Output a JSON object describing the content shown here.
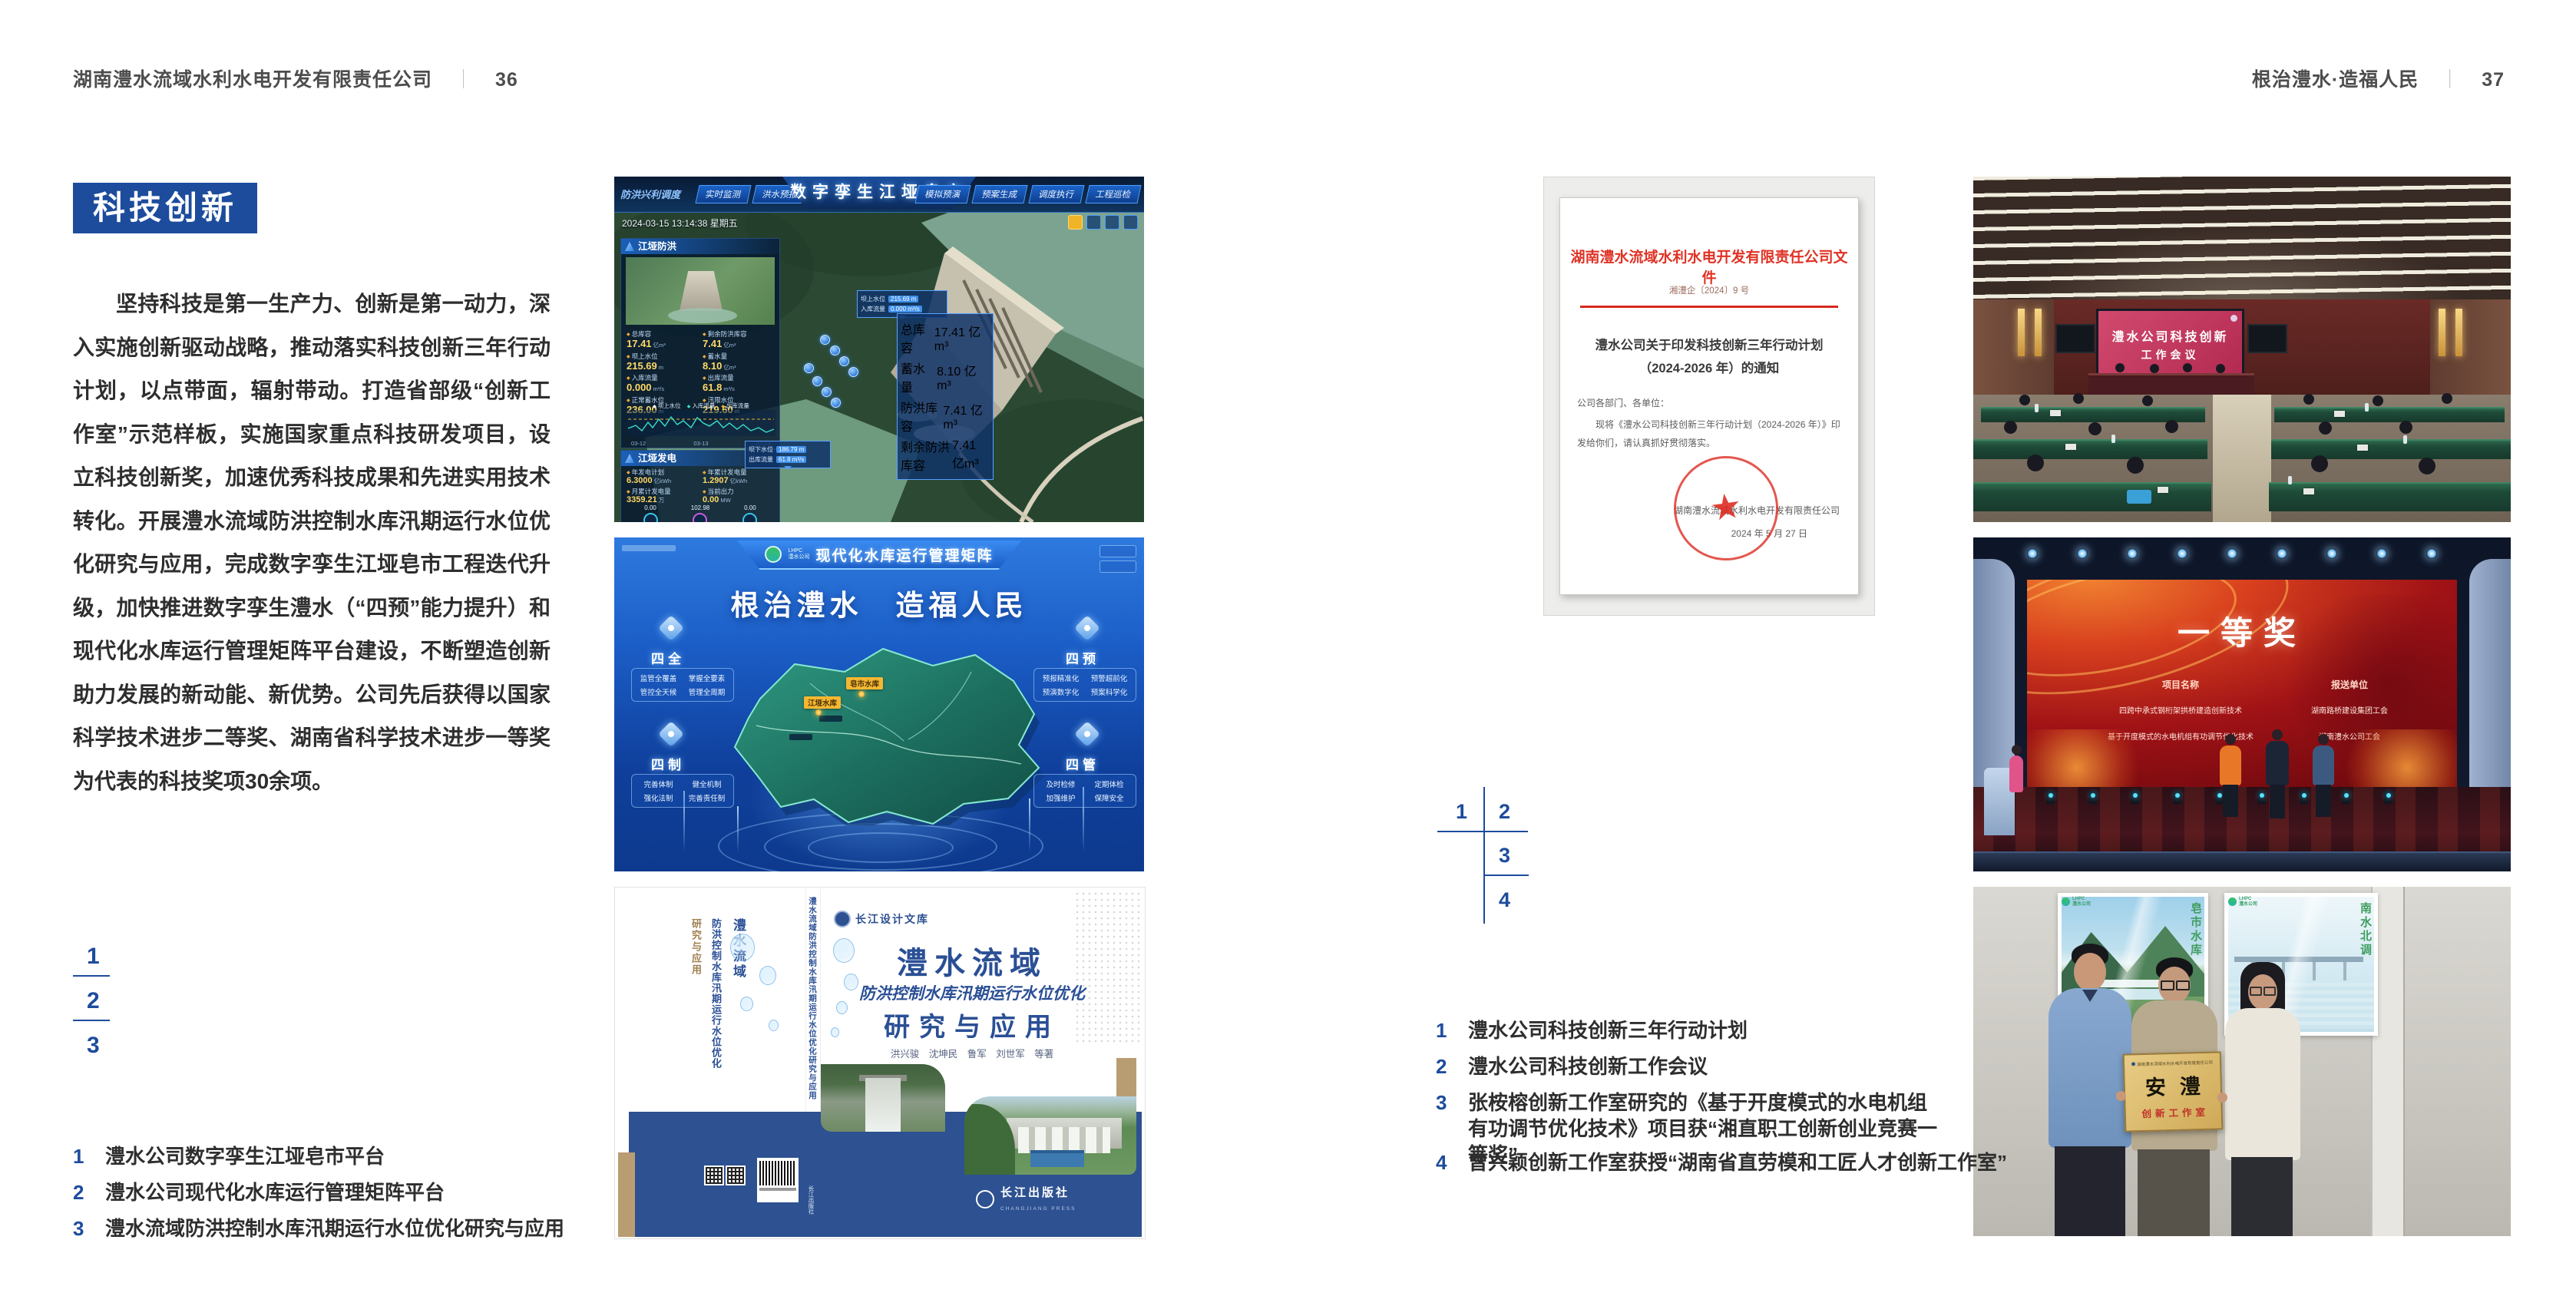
{
  "colors": {
    "accent_blue": "#1d4c9d",
    "body_text": "#2e2e2e",
    "doc_red": "#d7281e",
    "plaque_gold": "#cfa958"
  },
  "page_left": {
    "header": {
      "company": "湖南澧水流域水利水电开发有限责任公司",
      "separator": "｜",
      "page_number": "36"
    },
    "section_title": "科技创新",
    "paragraph": "坚持科技是第一生产力、创新是第一动力，深入实施创新驱动战略，推动落实科技创新三年行动计划，以点带面，辐射带动。打造省部级“创新工作室”示范样板，实施国家重点科技研发项目，设立科技创新奖，加速优秀科技成果和先进实用技术转化。开展澧水流域防洪控制水库汛期运行水位优化研究与应用，完成数字孪生江垭皂市工程迭代升级，加快推进数字孪生澧水（“四预”能力提升）和现代化水库运行管理矩阵平台建设，不断塑造创新助力发展的新动能、新优势。公司先后获得以国家科学技术进步二等奖、湖南省科学技术进步一等奖为代表的科技奖项30余项。",
    "figure_markers": [
      "1",
      "2",
      "3"
    ],
    "captions": [
      {
        "num": "1",
        "text": "澧水公司数字孪生江垭皂市平台"
      },
      {
        "num": "2",
        "text": "澧水公司现代化水库运行管理矩阵平台"
      },
      {
        "num": "3",
        "text": "澧水流域防洪控制水库汛期运行水位优化研究与应用"
      }
    ]
  },
  "page_right": {
    "header": {
      "motto": "根治澧水·造福人民",
      "separator": "｜",
      "page_number": "37"
    },
    "figure_markers": [
      "1",
      "2",
      "3",
      "4"
    ],
    "captions": [
      {
        "num": "1",
        "text": "澧水公司科技创新三年行动计划"
      },
      {
        "num": "2",
        "text": "澧水公司科技创新工作会议"
      },
      {
        "num": "3",
        "text": "张桉榕创新工作室研究的《基于开度模式的水电机组有功调节优化技术》项目获“湘直职工创新创业竞赛一等奖”"
      },
      {
        "num": "4",
        "text": "曾兴颖创新工作室获授“湖南省直劳模和工匠人才创新工作室”"
      }
    ]
  },
  "fig_dashboard": {
    "title": "数字孪生江垭皂市",
    "corner_label": "防洪兴利调度",
    "tabs_left": [
      "实时监测",
      "洪水预报",
      "防洪预警"
    ],
    "tabs_right": [
      "模拟预演",
      "预案生成",
      "调度执行",
      "工程巡检"
    ],
    "timestamp": "2024-03-15 13:14:38 星期五",
    "flood_panel": {
      "title": "江垭防洪",
      "stats": [
        {
          "label": "总库容",
          "value": "17.41",
          "unit": "亿m³"
        },
        {
          "label": "剩余防洪库容",
          "value": "7.41",
          "unit": "亿m³"
        },
        {
          "label": "坝上水位",
          "value": "215.69",
          "unit": "m"
        },
        {
          "label": "蓄水量",
          "value": "8.10",
          "unit": "亿m³"
        },
        {
          "label": "入库流量",
          "value": "0.000",
          "unit": "m³/s"
        },
        {
          "label": "出库流量",
          "value": "61.8",
          "unit": "m³/s"
        },
        {
          "label": "正常蓄水位",
          "value": "236.00",
          "unit": "m"
        },
        {
          "label": "汛限水位",
          "value": "219.60",
          "unit": "m"
        }
      ],
      "chart_legend": [
        "坝上水位",
        "入库流量",
        "出库流量"
      ],
      "chart_x": [
        "03-12",
        "03-13",
        "03-14"
      ]
    },
    "power_panel": {
      "title": "江垭发电",
      "stats": [
        {
          "label": "年发电计划",
          "value": "6.3000",
          "unit": "亿kWh"
        },
        {
          "label": "年累计发电量",
          "value": "1.2907",
          "unit": "亿kWh"
        },
        {
          "label": "月累计发电量",
          "value": "3359.21",
          "unit": "万"
        },
        {
          "label": "当前出力",
          "value": "0.00",
          "unit": "MW"
        },
        {
          "label": "发电流量",
          "value": "0.00",
          "unit": "m³/s"
        },
        {
          "label": "弃水流量",
          "value": "0.00",
          "unit": "m³/s"
        }
      ],
      "gauge_values": [
        "0.00",
        "102.98",
        "0.00"
      ]
    },
    "tooltip_upstream": [
      {
        "label": "坝上水位",
        "value": "215.69 m"
      },
      {
        "label": "入库流量",
        "value": "0.000 m³/s"
      }
    ],
    "tooltip_downstream": [
      {
        "label": "坝下水位",
        "value": "186.79 m"
      },
      {
        "label": "出库流量",
        "value": "61.8 m³/s"
      }
    ],
    "info_panel": [
      {
        "label": "总库容",
        "value": "17.41 亿m³"
      },
      {
        "label": "蓄水量",
        "value": "8.10 亿m³"
      },
      {
        "label": "防洪库容",
        "value": "7.41 亿m³"
      },
      {
        "label": "剩余防洪库容",
        "value": "7.41 亿m³"
      }
    ]
  },
  "fig_matrix": {
    "logo_abbr": "LHPC",
    "logo_name": "澧水公司",
    "title": "现代化水库运行管理矩阵",
    "slogan": "根治澧水　造福人民",
    "groups": [
      {
        "name": "四全",
        "items": [
          "监管全覆盖",
          "掌握全要素",
          "管控全天候",
          "管理全周期"
        ]
      },
      {
        "name": "四预",
        "items": [
          "预报精准化",
          "预警超前化",
          "预演数字化",
          "预案科学化"
        ]
      },
      {
        "name": "四制",
        "items": [
          "完善体制",
          "健全机制",
          "强化法制",
          "完善责任制"
        ]
      },
      {
        "name": "四管",
        "items": [
          "及时检修",
          "定期体检",
          "加强维护",
          "保障安全"
        ]
      }
    ],
    "map_labels": [
      "皂市水库",
      "江垭水库"
    ]
  },
  "fig_book": {
    "series_badge": "长江设计文库",
    "title_main": "澧水流域",
    "title_sub": "防洪控制水库汛期运行水位优化",
    "title_tail": "研究与应用",
    "authors": "洪兴骏　沈坤民　鲁军　刘世军　等著",
    "publisher": "长江出版社",
    "publisher_en": "CHANGJIANG PRESS",
    "spine_title": "澧水流域防洪控制水库汛期运行水位优化研究与应用",
    "spine_publisher": "长江出版社",
    "back_title_1": "澧水流域",
    "back_title_2": "防洪控制水库汛期运行水位优化",
    "back_title_3": "研究与应用"
  },
  "fig_document": {
    "header": "湖南澧水流域水利水电开发有限责任公司文件",
    "doc_number": "湘澧企〔2024〕9 号",
    "title_line1": "澧水公司关于印发科技创新三年行动计划",
    "title_line2": "（2024-2026 年）的通知",
    "salutation": "公司各部门、各单位：",
    "body_line1": "现将《澧水公司科技创新三年行动计划（2024-2026 年）》印",
    "body_line2": "发给你们，请认真抓好贯彻落实。",
    "signer": "湖南澧水流域水利水电开发有限责任公司",
    "date": "2024 年 5 月 27 日"
  },
  "fig_meeting": {
    "screen_line1": "澧水公司科技创新",
    "screen_line2": "工作会议"
  },
  "fig_award": {
    "title": "一等奖",
    "col_project": "项目名称",
    "col_unit": "报送单位",
    "rows": [
      {
        "project": "四跨中承式钢桁架拱桥建造创新技术",
        "unit": "湖南路桥建设集团工会"
      },
      {
        "project": "基于开度模式的水电机组有功调节优化技术",
        "unit": "湖南澧水公司工会"
      }
    ]
  },
  "fig_plaque": {
    "plaque_org": "湖南澧水流域水利水电开发有限责任公司",
    "plaque_name": "安澧",
    "plaque_sub": "创新工作室",
    "poster_left_caption": "皂市水库",
    "poster_right_caption": "南水北调",
    "logo_abbr": "LHPC",
    "logo_name": "澧水公司"
  }
}
